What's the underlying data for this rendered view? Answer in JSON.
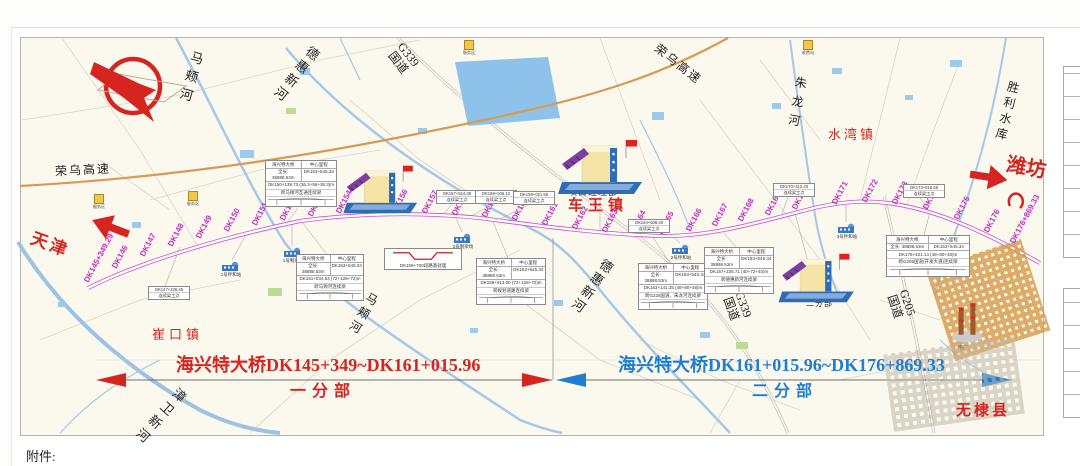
{
  "header": {
    "attachment_label": "附件:"
  },
  "colors": {
    "route": "#cc4fcc",
    "section_one": "#d62420",
    "section_two": "#1e7ed2",
    "river": "#a4c8e8",
    "expressway": "#d79a52",
    "marker_text": "#bf2fbf"
  },
  "labels": {
    "tianjin": "天津",
    "weifang": "潍坊",
    "rongwu1": "荣乌高速",
    "rongwu2": "荣乌高速",
    "g339": "G339",
    "g205": "G205",
    "guodao": "国道"
  },
  "rivers": {
    "majia": "马颊河",
    "dehui": "德惠新河",
    "zhulong": "朱龙河",
    "shengli_reservoir": "胜利水库",
    "zhangwei": "漳卫新河"
  },
  "towns": {
    "cuikou": "崔口镇",
    "chewang": "车王镇",
    "shuiwan": "水湾镇",
    "wudi": "无棣县"
  },
  "facilities": {
    "hq": "项目经理部",
    "div1": "一分部",
    "div2": "二分部",
    "plant": "电厂"
  },
  "sections": {
    "one": {
      "range": "海兴特大桥DK145+349~DK161+015.96",
      "name": "一分部"
    },
    "two": {
      "range": "海兴特大桥DK161+015.96~DK176+869.33",
      "name": "二分部"
    }
  },
  "route": {
    "markers": [
      "DK145+349.29",
      "DK146",
      "DK147",
      "DK148",
      "DK149",
      "DK150",
      "DK151",
      "DK152",
      "DK153",
      "DK154",
      "DK155",
      "DK156",
      "DK157",
      "DK158",
      "DK159",
      "DK160",
      "DK161",
      "DK162",
      "DK163",
      "DK164",
      "DK165",
      "DK166",
      "DK167",
      "DK168",
      "DK169",
      "DK170",
      "DK171",
      "DK172",
      "DK173",
      "DK174",
      "DK175",
      "DK176",
      "DK176+869.33"
    ]
  },
  "info_boxes": {
    "header": [
      "海兴特大桥",
      "中心里程"
    ],
    "subheader": [
      "全长: 38888.53m",
      "DK153+545.34"
    ],
    "large": [
      {
        "line3": "DK150+139.73 (36.3+56+36.3)m",
        "line4": "跨马颊河互通连续梁"
      },
      {
        "line3": "DK151+034.53 (72+128+72)m",
        "line4": "跨马颊河连续梁"
      },
      {
        "line3": "DK158+013.00 (72+128+72)m",
        "line4": "跨规划道路连续梁"
      },
      {
        "line3": "DK163+141.35 (48+80+48)m",
        "line4": "跨G228国道、朱龙河连续梁"
      },
      {
        "line3": "DK167+226.71 (40+72+40)m",
        "line4": "跨德惠新河连续梁"
      },
      {
        "line3": "DK176+421.14 (48+80+48)m",
        "line4": "跨G205国道(开发大道)连续梁"
      }
    ],
    "small": [
      [
        "DK147+236.45",
        "连续梁工点"
      ],
      [
        "DK157+524.38",
        "连续梁工点"
      ],
      [
        "DK158+046.12",
        "连续梁工点"
      ],
      [
        "DK159+021.55",
        "连续梁工点"
      ],
      [
        "DK164+508.40",
        "连续梁工点"
      ],
      [
        "DK170+312.20",
        "连续梁工点"
      ],
      [
        "DK173+618.55",
        "连续梁工点"
      ]
    ],
    "culvert_caption": "DK159+700段路基处理"
  },
  "stations": [
    "1号拌和站",
    "1号制梁场",
    "2号制梁场",
    "2号拌和站",
    "3号拌和站"
  ],
  "pois": [
    "服务区",
    "服务区",
    "服务区",
    "收费站"
  ]
}
